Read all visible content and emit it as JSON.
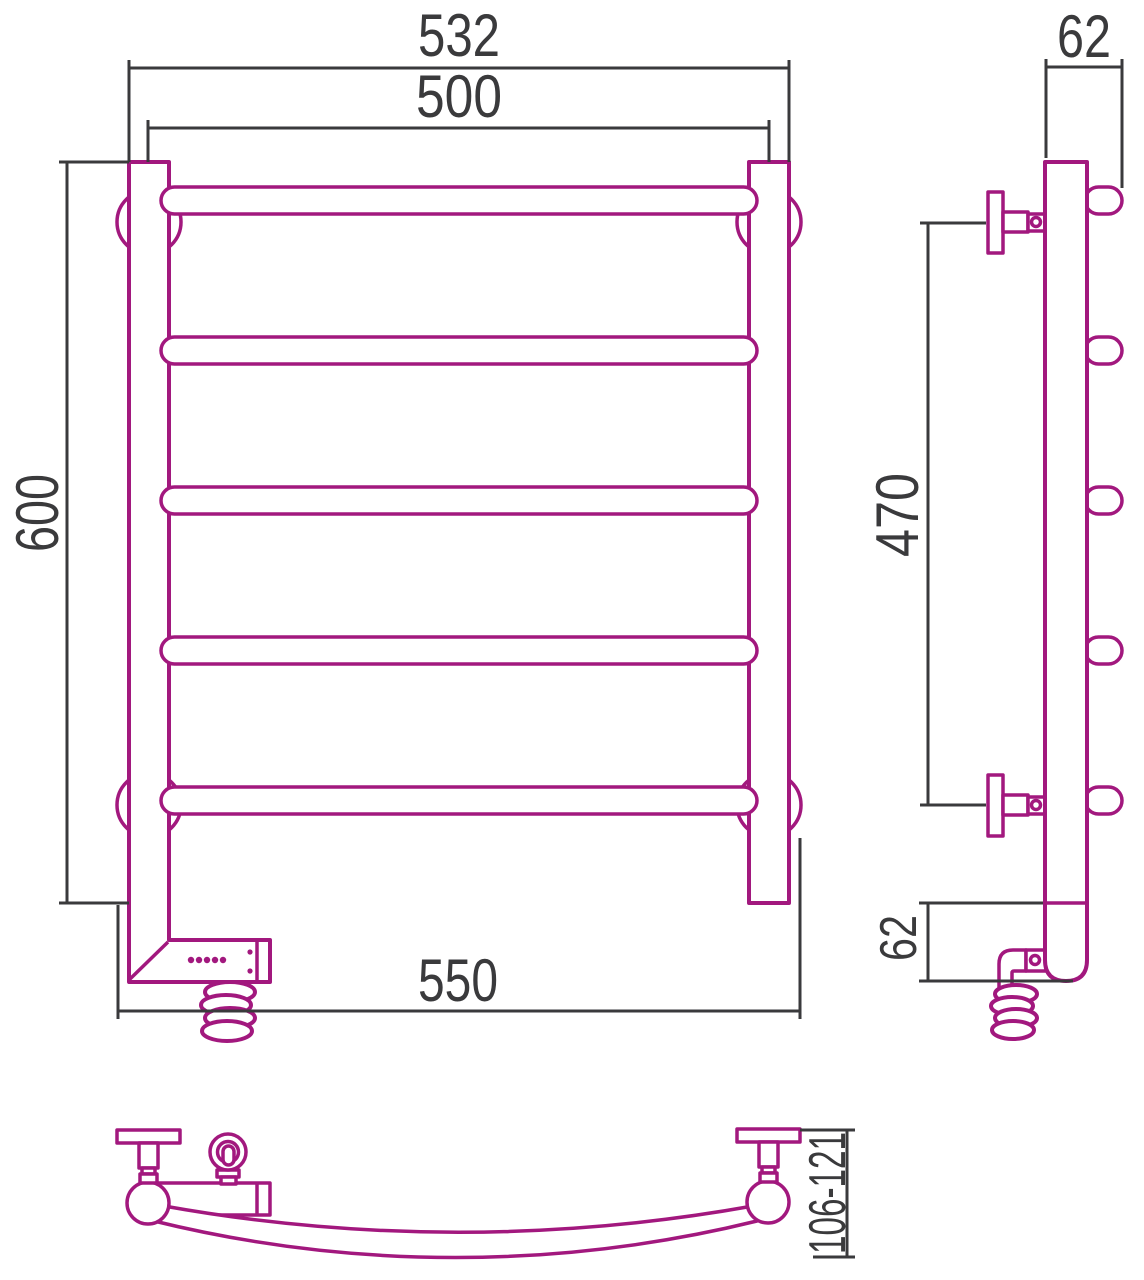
{
  "page": {
    "background": "#ffffff"
  },
  "drawing": {
    "description": "Electric heated towel rail, ladder type with 5 bowed rungs, three orthographic views with dimensions",
    "colors": {
      "outline": "#A2187E",
      "dimension": "#3A3A3C"
    },
    "front": {
      "width_outer": "532",
      "width_centers": "500",
      "height": "600",
      "width_bottom": "550"
    },
    "side": {
      "depth_top": "62",
      "mount_span": "470",
      "depth_bottom": "62"
    },
    "top": {
      "wall_clearance": "106-121"
    }
  }
}
